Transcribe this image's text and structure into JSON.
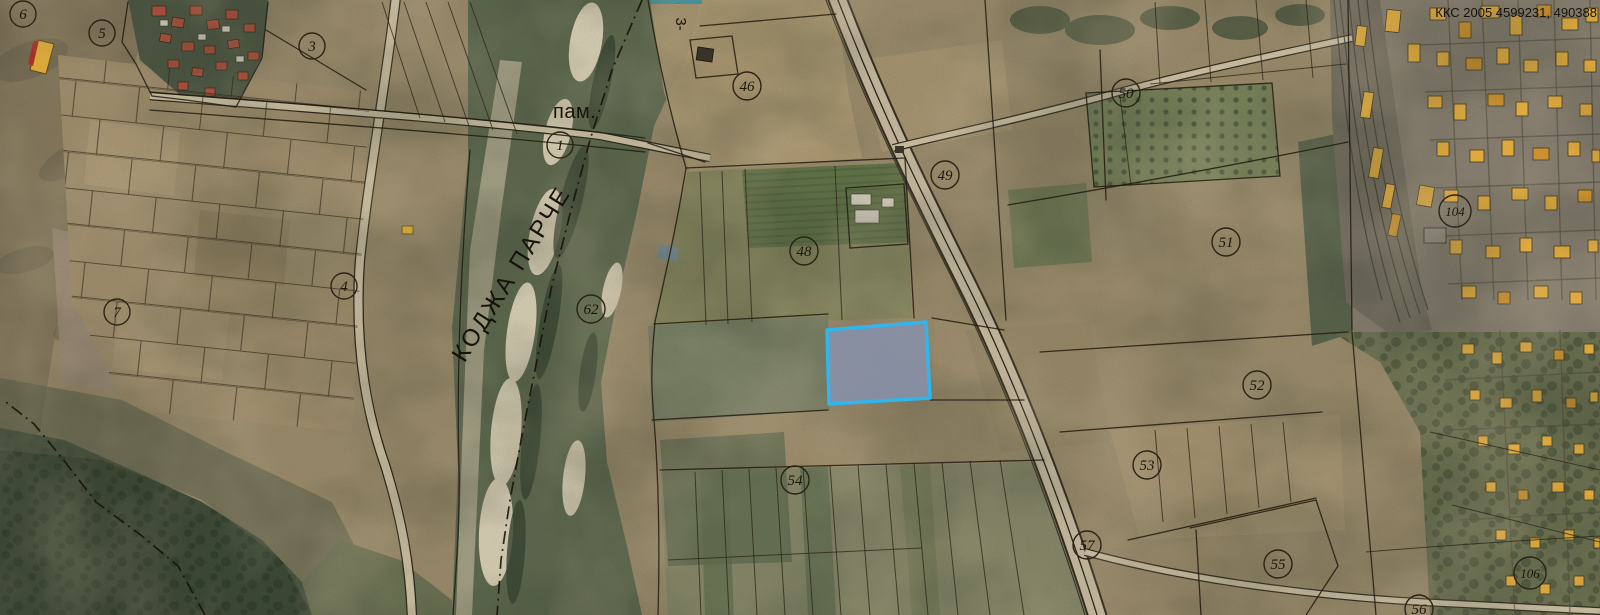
{
  "map": {
    "highlighted_parcel": {
      "points": "827,330 926,322 930,398 829,404",
      "stroke": "#2fb6ee",
      "fill": "#8891aa"
    },
    "parcel_markers": [
      {
        "label": "6",
        "x": 23,
        "y": 14
      },
      {
        "label": "5",
        "x": 102,
        "y": 33
      },
      {
        "label": "3",
        "x": 312,
        "y": 46
      },
      {
        "label": "1",
        "x": 560,
        "y": 145
      },
      {
        "label": "7",
        "x": 117,
        "y": 312
      },
      {
        "label": "4",
        "x": 344,
        "y": 286
      },
      {
        "label": "62",
        "x": 591,
        "y": 309
      },
      {
        "label": "46",
        "x": 747,
        "y": 86
      },
      {
        "label": "48",
        "x": 804,
        "y": 251
      },
      {
        "label": "49",
        "x": 945,
        "y": 175
      },
      {
        "label": "50",
        "x": 1126,
        "y": 93
      },
      {
        "label": "51",
        "x": 1226,
        "y": 242
      },
      {
        "label": "52",
        "x": 1257,
        "y": 385
      },
      {
        "label": "53",
        "x": 1147,
        "y": 465
      },
      {
        "label": "54",
        "x": 795,
        "y": 480
      },
      {
        "label": "55",
        "x": 1278,
        "y": 564
      },
      {
        "label": "57",
        "x": 1087,
        "y": 545
      },
      {
        "label": "56",
        "x": 1419,
        "y": 609
      },
      {
        "label": "104",
        "x": 1455,
        "y": 211
      },
      {
        "label": "106",
        "x": 1530,
        "y": 573
      }
    ],
    "labels": [
      {
        "name": "monument-label",
        "text": "пам.",
        "x": 553,
        "y": 118,
        "size": 20,
        "anchor": "start",
        "rotate": 0,
        "spacing": 0.5
      },
      {
        "name": "river-name-label",
        "text": "КОДЖА ПАРЧЕ",
        "x": 518,
        "y": 278,
        "size": 24,
        "anchor": "middle",
        "rotate": -58,
        "spacing": 2.5
      },
      {
        "name": "road-number-label",
        "text": "3-",
        "x": 676,
        "y": 24,
        "size": 15,
        "anchor": "middle",
        "rotate": 90,
        "spacing": 0
      },
      {
        "name": "coordinate-readout",
        "text": "ККС 2005 4599231, 490388",
        "x": 1597,
        "y": 17,
        "size": 13,
        "anchor": "end",
        "rotate": 0,
        "spacing": 0
      }
    ],
    "colors": {
      "highlight_stroke": "#2fb6ee",
      "highlight_fill": "#8891aa",
      "building_yellow": "#edb441",
      "building_orange": "#d8992f",
      "roof_red": "#b2543e",
      "boundary_line": "#221c10",
      "river_green": "#5f6b50",
      "field_tan": "#9d8d6d",
      "forest_green": "#3f4c38"
    }
  }
}
